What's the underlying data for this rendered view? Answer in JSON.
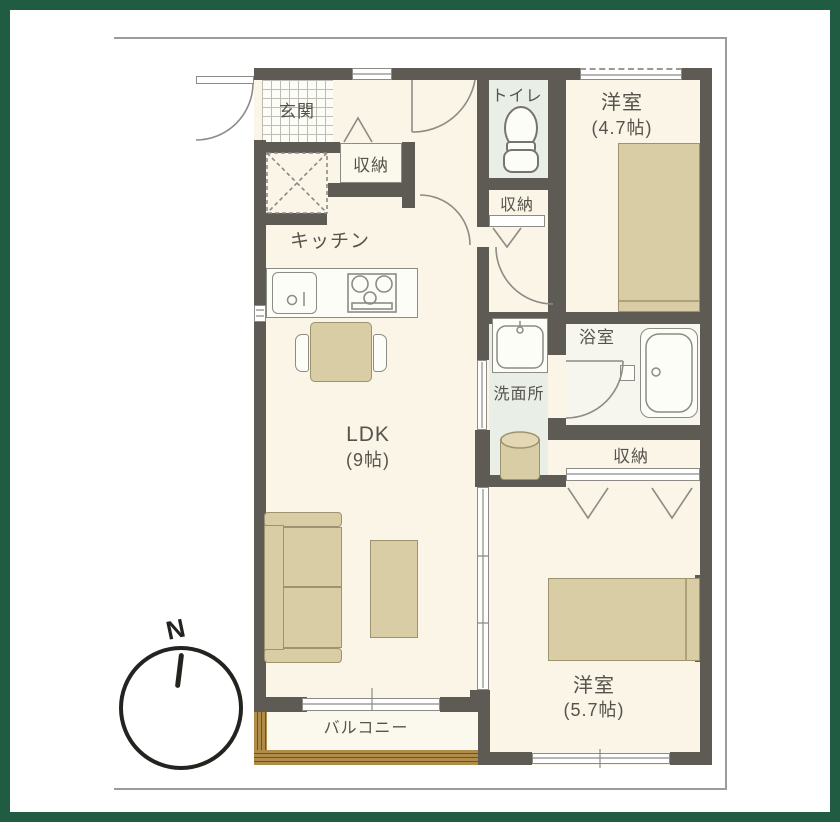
{
  "rooms": {
    "genkan": {
      "label": "玄関"
    },
    "hall_storage": {
      "label": "収納"
    },
    "kitchen": {
      "label": "キッチン"
    },
    "toilet": {
      "label": "トイレ"
    },
    "toilet_storage": {
      "label": "収納"
    },
    "bedroom_small": {
      "label": "洋室",
      "size": "(4.7帖)"
    },
    "ldk": {
      "label": "LDK",
      "size": "(9帖)"
    },
    "washroom": {
      "label": "洗面所"
    },
    "bathroom": {
      "label": "浴室"
    },
    "bedroom_storage": {
      "label": "収納"
    },
    "bedroom_main": {
      "label": "洋室",
      "size": "(5.7帖)"
    },
    "balcony": {
      "label": "バルコニー"
    }
  },
  "compass": {
    "label": "N"
  },
  "colors": {
    "green_border": "#1f5c41",
    "wall": "#5d5b54",
    "floor_cream": "#faf5e6",
    "floor_light": "#fbf9ee",
    "room_green": "#e9efe7",
    "bath_floor": "#f7f6ee",
    "furniture_tan": "#d9cda5",
    "furniture_border": "#9d9371",
    "wood": "#b08c4a",
    "wood_line": "#6b5426",
    "line_gray": "#8c8b85",
    "frame": "#9c9c9c",
    "text": "#55534c"
  }
}
